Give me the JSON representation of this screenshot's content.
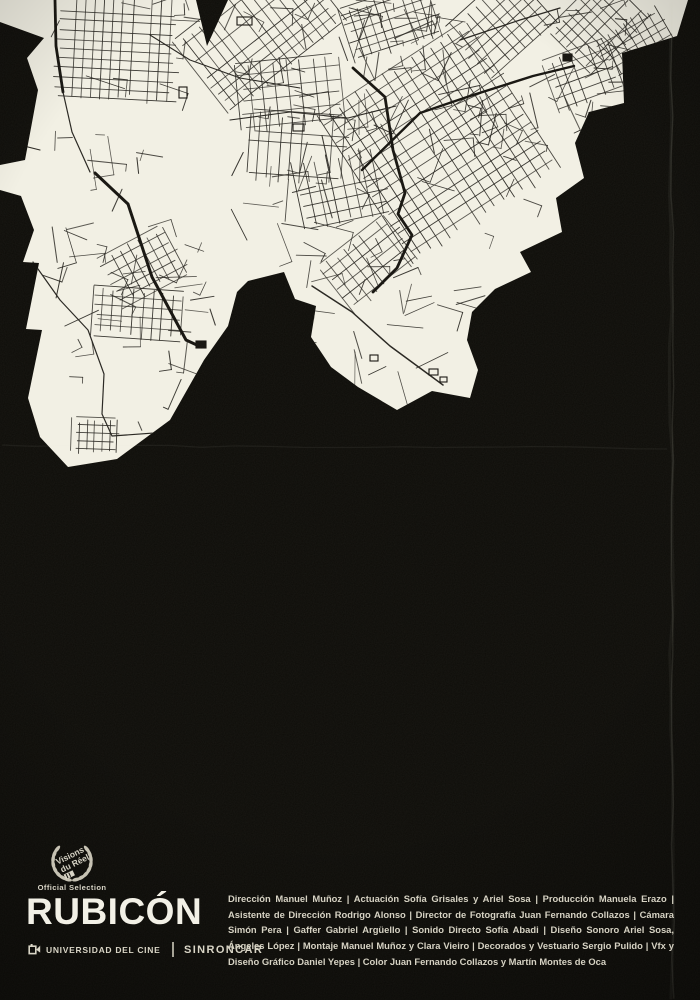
{
  "poster": {
    "title": "RUBICÓN",
    "badge": {
      "festival_line1": "Visions",
      "festival_line2": "du Réel",
      "label": "Official Selection"
    },
    "producers": {
      "university": "UNIVERSIDAD DEL CINE",
      "company": "SINRONCAR"
    },
    "credits": "Dirección Manuel Muñoz | Actuación Sofía Grisales y Ariel Sosa | Producción Manuela Erazo | Asistente de Dirección Rodrigo Alonso | Director de Fotografía Juan Fernando Collazos | Cámara Simón Pera | Gaffer Gabriel Argüello | Sonido Directo Sofía Abadi | Diseño Sonoro Ariel Sosa, Ángeles López | Montaje Manuel Muñoz y Clara Vieiro | Decorados y Vestuario Sergio Pulido | Vfx y Diseño Gráfico Daniel Yepes | Color Juan Fernando Collazos y Martín Montes de Oca",
    "colors": {
      "background": "#0d0c08",
      "map_fill": "#f2f0e4",
      "streets": "#26241f",
      "main_roads": "#14120d",
      "text": "#d6d2c3"
    },
    "icons": {
      "badge": "laurel-wreath-icon",
      "university_logo": "film-flag-icon"
    }
  }
}
